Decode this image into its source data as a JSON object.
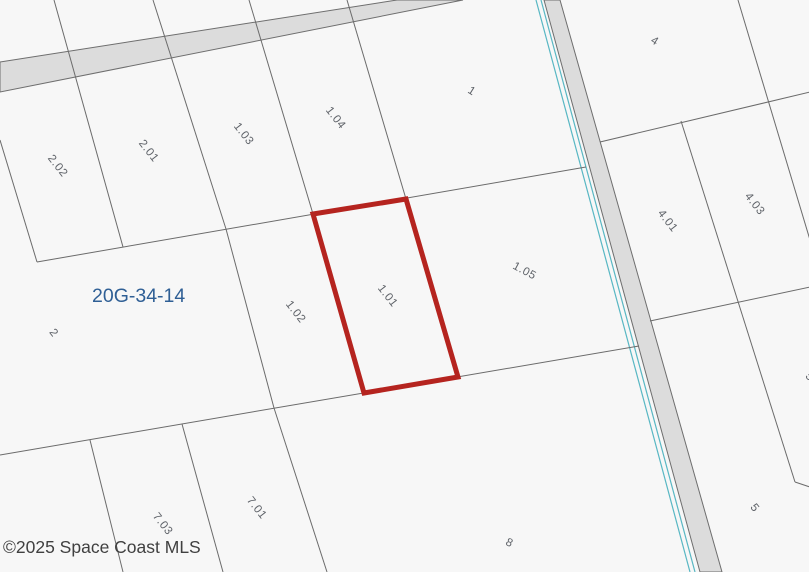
{
  "map": {
    "section_label": "20G-34-14",
    "copyright": "©2025 Space Coast MLS",
    "highlighted_parcel": "1.01",
    "edge_partial_label": "5",
    "parcels": [
      {
        "id": "2.02",
        "label": "2.02"
      },
      {
        "id": "2.01",
        "label": "2.01"
      },
      {
        "id": "1.03",
        "label": "1.03"
      },
      {
        "id": "1.04",
        "label": "1.04"
      },
      {
        "id": "1",
        "label": "1"
      },
      {
        "id": "4",
        "label": "4"
      },
      {
        "id": "2",
        "label": "2"
      },
      {
        "id": "1.02",
        "label": "1.02"
      },
      {
        "id": "1.01",
        "label": "1.01"
      },
      {
        "id": "1.05",
        "label": "1.05"
      },
      {
        "id": "4.01",
        "label": "4.01"
      },
      {
        "id": "4.03",
        "label": "4.03"
      },
      {
        "id": "7.03",
        "label": "7.03"
      },
      {
        "id": "7.01",
        "label": "7.01"
      },
      {
        "id": "8",
        "label": "8"
      },
      {
        "id": "5",
        "label": "5"
      }
    ],
    "colors": {
      "background": "#f7f7f7",
      "road_fill": "#dcdcdc",
      "road_outline": "#6e6e6e",
      "parcel_line": "#6b6b6b",
      "water_line": "#58b7c3",
      "highlight": "#b5241f",
      "section_label": "#2f5f95",
      "label": "#5f6369",
      "copyright": "#404040"
    }
  }
}
